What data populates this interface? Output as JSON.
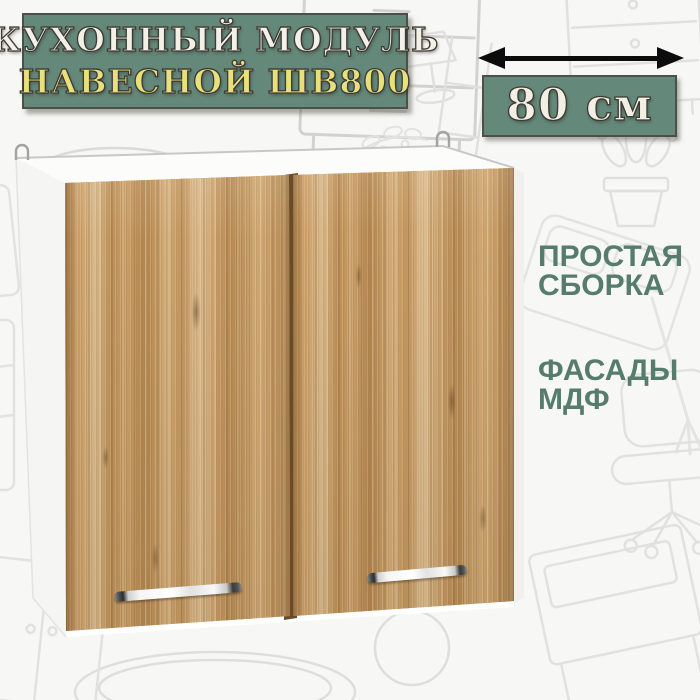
{
  "title_plate": {
    "line1": "КУХОННЫЙ МОДУЛЬ",
    "line2": "НАВЕСНОЙ ШВ800"
  },
  "dimension_plate": {
    "value": "80 см",
    "arrow_icon": "double-headed-horizontal-arrow"
  },
  "features": [
    {
      "line1": "ПРОСТАЯ",
      "line2": "СБОРКА"
    },
    {
      "line1": "ФАСАДЫ",
      "line2": "МДФ"
    }
  ],
  "cabinet": {
    "door_count": 2,
    "handle_count": 2,
    "mount_hook_count": 2,
    "finish": "oak wood front, white carcass"
  },
  "colors": {
    "plate_green": "#64897b",
    "feature_text_green": "#567c6f",
    "title_text": "#f3f0e8",
    "subtitle_text": "#e8df7d",
    "dimension_text": "#f2efe5",
    "arrow_black": "#0c0c0c",
    "wood_base": "#c69d67",
    "carcass_white": "#fcfcfb",
    "page_background": "#f7f7f5"
  }
}
